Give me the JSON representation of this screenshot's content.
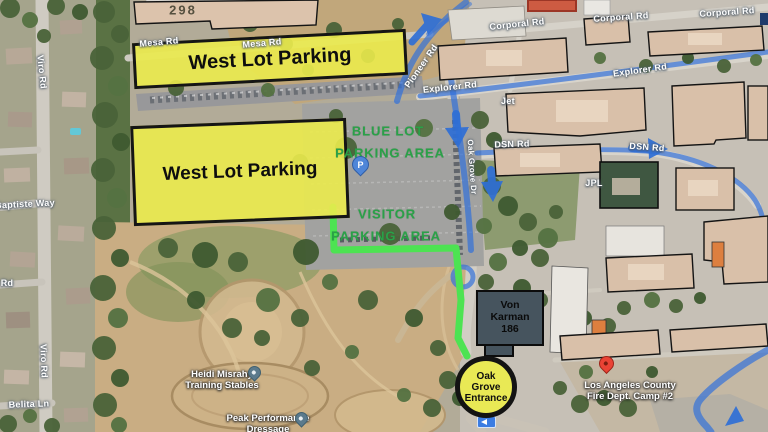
{
  "overlays": {
    "west_lot_top": "West Lot Parking",
    "west_lot_main": "West Lot Parking",
    "blue_lot_line1": "BLUE LOT",
    "blue_lot_line2": "PARKING AREA",
    "visitor_lot_line1": "VISITOR",
    "visitor_lot_line2": "PARKING AREA",
    "von_karman_line1": "Von",
    "von_karman_line2": "Karman",
    "von_karman_line3": "186",
    "oak_grove_line1": "Oak",
    "oak_grove_line2": "Grove",
    "oak_grove_line3": "Entrance"
  },
  "roads": [
    {
      "text": "Mesa Rd"
    },
    {
      "text": "Mesa Rd"
    },
    {
      "text": "Pioneer Rd"
    },
    {
      "text": "Corporal Rd"
    },
    {
      "text": "Corporal Rd"
    },
    {
      "text": "Corporal Rd"
    },
    {
      "text": "Explorer Rd"
    },
    {
      "text": "Explorer Rd"
    },
    {
      "text": "DSN Rd"
    },
    {
      "text": "DSN Rd"
    },
    {
      "text": "Oak Grove Dr"
    },
    {
      "text": "Viro Rd"
    },
    {
      "text": "Viro Rd"
    },
    {
      "text": "Baptiste Way"
    },
    {
      "text": "Belita Ln"
    },
    {
      "text": "Rd"
    }
  ],
  "pois": {
    "building_298": "298",
    "jet": "Jet",
    "jpl": "JPL",
    "stables_line1": "Heidi Misrahy",
    "stables_line2": "Training Stables",
    "dressage_line1": "Peak Performance",
    "dressage_line2": "Dressage",
    "fire_line1": "Los Angeles County",
    "fire_line2": "Fire Dept. Camp #2",
    "parking_icon": "P"
  },
  "colors": {
    "highlight_yellow": "#ebeb4d",
    "route_green": "#4de352",
    "lot_label_green": "#2aa148",
    "nav_blue": "#2f6fd6",
    "building_tan": "#d9c0a9",
    "building_green": "#3f5741",
    "von_karman_gray": "#46545e",
    "pin_red": "#ea4335"
  }
}
